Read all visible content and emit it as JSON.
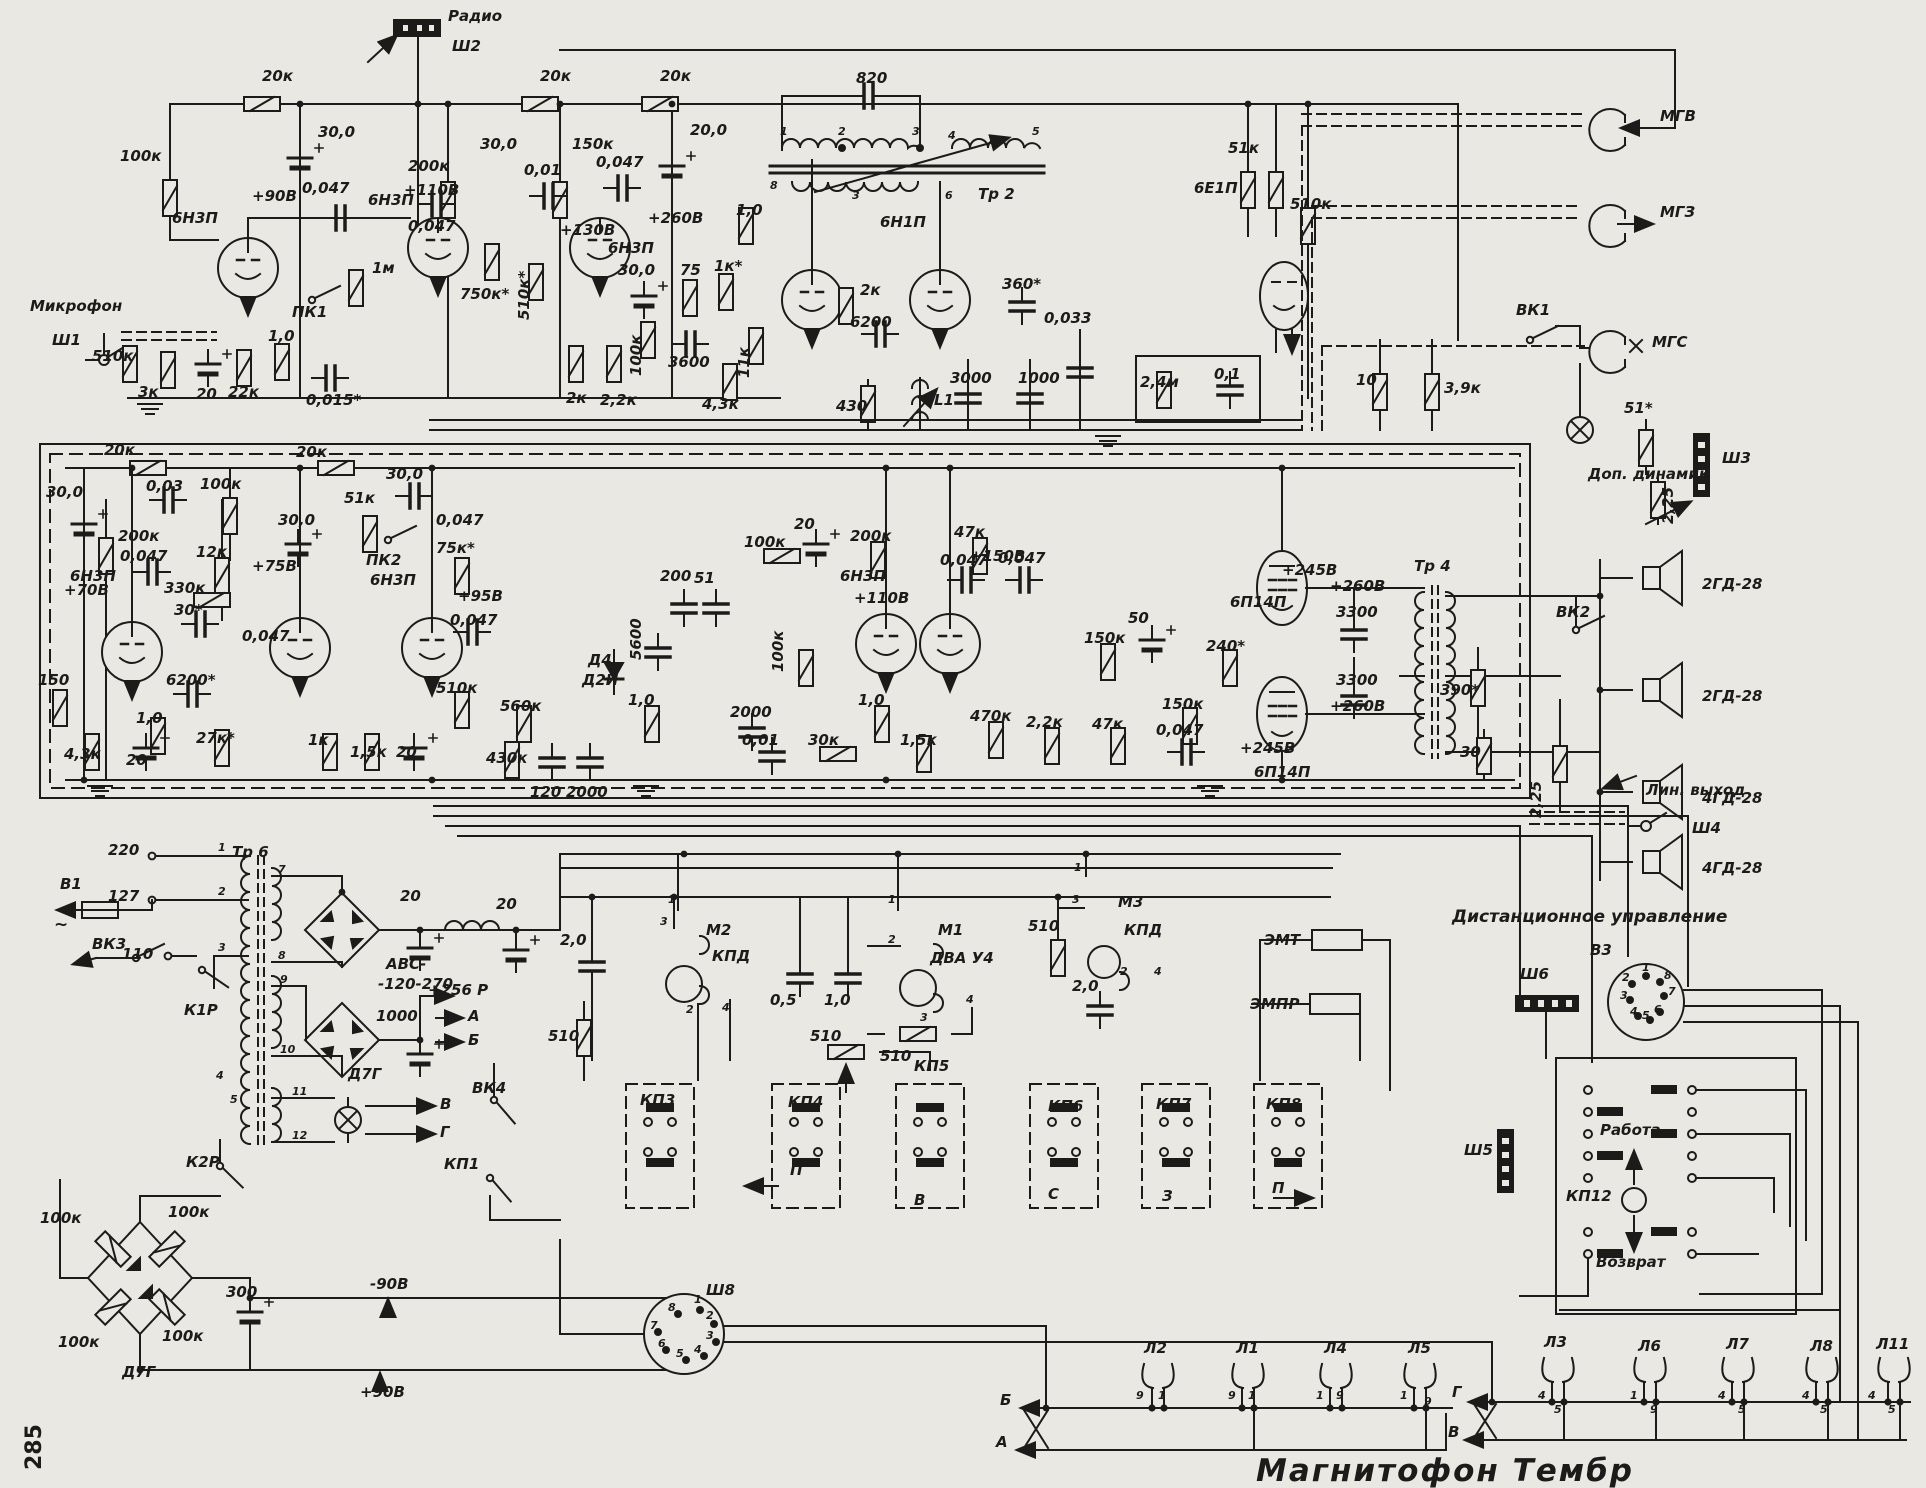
{
  "title": "Магнитофон Тембр",
  "page_number": "285",
  "top": {
    "values": [
      "20к",
      "20к",
      "20к",
      "100к",
      "30,0",
      "+90В",
      "0,047",
      "1м",
      "ПК1",
      "510к",
      "3к",
      "20",
      "22к",
      "1,0",
      "0,015*",
      "200к",
      "+110В",
      "30,0",
      "0,047",
      "150к",
      "0,01",
      "0,047",
      "20,0",
      "+260В",
      "+130В",
      "750к*",
      "510к*",
      "2к",
      "2,2к",
      "100к",
      "30,0",
      "75",
      "1к*",
      "3600",
      "11к",
      "4,3к",
      "1,0",
      "820",
      "Тр 2",
      "6Н1П",
      "2к",
      "6200",
      "430",
      "L1",
      "3000",
      "1000",
      "360*",
      "0,033",
      "2,4м",
      "0,1",
      "51к",
      "510к",
      "10",
      "3,9к",
      "51*",
      "2,25",
      "Доп. динамик",
      "Ш3",
      "МГВ",
      "МГЗ",
      "МГС",
      "ВК1",
      "Микрофон",
      "Ш1",
      "Радио",
      "Ш2",
      "6Н3П",
      "6Н3П",
      "6Н3П",
      "6Е1П"
    ],
    "tr2_pins": [
      "1",
      "2",
      "3",
      "4",
      "5",
      "8",
      "3",
      "6"
    ]
  },
  "mid": {
    "values": [
      "20к",
      "0,03",
      "100к",
      "30,0",
      "200к",
      "0,047",
      "+70В",
      "330к",
      "30*",
      "12к",
      "30,0",
      "+75В",
      "0,047",
      "20к",
      "51к",
      "ПК2",
      "30,0",
      "510к",
      "1,0",
      "6200*",
      "27к*",
      "150",
      "4,3к",
      "20",
      "1к",
      "1,5к",
      "20",
      "75к*",
      "0,047",
      "+95В",
      "0,047",
      "5600",
      "Д4",
      "Д2И",
      "560к",
      "430к",
      "120",
      "2000",
      "100к",
      "200",
      "51",
      "100к",
      "2000",
      "0,01",
      "30к",
      "1,0",
      "1,0",
      "20",
      "+110В",
      "0,047",
      "200к",
      "47к",
      "+150В",
      "0,047",
      "1,5к",
      "470к",
      "2,2к",
      "47к",
      "150к",
      "50",
      "240*",
      "150к",
      "0,047",
      "+245В",
      "+260В",
      "3300",
      "3300",
      "+260В",
      "+245В",
      "390*",
      "30",
      "2,25",
      "Тр 4",
      "6Н3П",
      "6Н3П",
      "6Н3П",
      "6П14П",
      "6П14П",
      "ВК2",
      "2ГД-28",
      "2ГД-28",
      "4ГД-28",
      "4ГД-28",
      "Лин. выход",
      "Ш4"
    ]
  },
  "psu": {
    "values": [
      "220",
      "127",
      "110",
      "Тр 6",
      "В1",
      "ВК3",
      "К1Р",
      "20",
      "20",
      "АВС-",
      "-120-270",
      "1000",
      "+256 Р",
      "А",
      "Б",
      "Д7Г",
      "В",
      "Г",
      "ВК4",
      "КП1",
      "К2Р",
      "100к",
      "100к",
      "100к",
      "100к",
      "Д7Г",
      "300",
      "-90В",
      "+90В",
      "~"
    ],
    "tr6_pins": [
      "1",
      "2",
      "3",
      "4",
      "5",
      "7",
      "8",
      "9",
      "10",
      "11",
      "12"
    ]
  },
  "mech": {
    "values": [
      "2,0",
      "510",
      "М2",
      "КПД",
      "0,5",
      "1,0",
      "510",
      "М1",
      "ДВА У4",
      "510",
      "510",
      "М3",
      "КПД",
      "2,0",
      "ЭМТ",
      "ЭМПР",
      "КП3",
      "КП4",
      "П",
      "КП5",
      "В",
      "КП6",
      "С",
      "КП7",
      "З",
      "КП8",
      "П",
      "Ш8"
    ],
    "motor_pins": [
      "1",
      "3",
      "2",
      "4",
      "1",
      "2",
      "3",
      "4",
      "1",
      "3",
      "2",
      "4"
    ],
    "sh8_pins": [
      "1",
      "2",
      "3",
      "4",
      "5",
      "6",
      "7",
      "8"
    ]
  },
  "remote": {
    "values": [
      "Дистанционное управление",
      "В3",
      "Ш6",
      "Ш5",
      "Работа",
      "КП12",
      "Возврат"
    ],
    "v3_pins": [
      "1",
      "2",
      "8",
      "3",
      "7",
      "4",
      "5",
      "6"
    ]
  },
  "lamps": {
    "values": [
      "Л2",
      "Л1",
      "Л4",
      "Л5",
      "Б",
      "А",
      "Л3",
      "Л6",
      "Л7",
      "Л8",
      "Л11",
      "Г",
      "В"
    ],
    "pins": [
      "9",
      "1",
      "9",
      "1",
      "1",
      "9",
      "1",
      "9",
      "4",
      "5",
      "1",
      "9",
      "4",
      "5",
      "4",
      "5",
      "4",
      "5"
    ]
  }
}
